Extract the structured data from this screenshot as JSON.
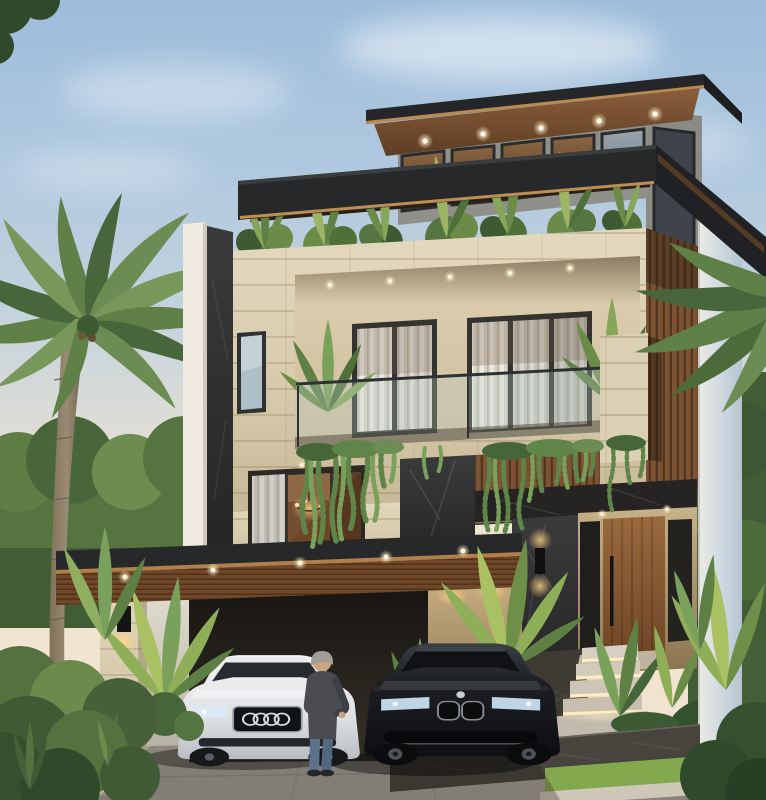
{
  "scene": {
    "kind": "architectural-exterior-3d-render",
    "subject": "modern three-storey tropical villa",
    "time_of_day": "dusk, warm interior and soffit lights on",
    "building": {
      "storeys": 3,
      "features": [
        "flat cantilevered dark roofs with wood soffits and recessed downlights",
        "clerestory window band on top floor",
        "roof-garden planter with tropical shrubs",
        "beige travertine facade with recessed balcony",
        "glass balustrade balcony with curtained windows",
        "hanging vine cascades over balcony fascia",
        "dark marble accent walls and entry header",
        "vertical wood slat cladding",
        "wood pivot front door with sidelights and black handle",
        "carport canopy with slatted wood underside and downlights",
        "lit entry steps with strip lighting",
        "tall rounded white pillar on right"
      ]
    },
    "vehicles": [
      {
        "type": "sedan",
        "color": "white",
        "grille_badge": "four overlapping rings"
      },
      {
        "type": "sedan",
        "color": "black",
        "grille_badge": "twin kidney grille"
      }
    ],
    "people": [
      {
        "description": "grey-haired man standing between the two cars",
        "clothing": "dark jacket and blue jeans"
      }
    ],
    "vegetation": [
      "coconut palm left",
      "palm fronds right edge",
      "background trees",
      "roof-garden shrubs",
      "hanging vines",
      "tropical planters",
      "hedges and lawn strips"
    ],
    "lighting": [
      "soffit downlights",
      "clerestory interior lights",
      "chandelier in first-floor window",
      "wall sconces",
      "step strip lights"
    ]
  },
  "palette": {
    "sky-top": "#9DBCDA",
    "sky-horizon": "#F2E6D2",
    "roof-dark": "#26282A",
    "gold-trim": "#BE8E55",
    "soffit-wood": "#7E5536",
    "slat-wood": "#7D5433",
    "stone-beige": "#DCD0B4",
    "marble-dark": "#312F2D",
    "white-wall": "#EFEBE1",
    "pillar-blue": "#C3D0DA",
    "glass-cool": "#9FB0B8",
    "interior-warm": "#8A5E38",
    "light-warm": "#FFE9B8",
    "foliage-dark": "#3C5733",
    "foliage-mid": "#587B41",
    "foliage-light": "#7FA055",
    "foliage-bright": "#A9C163",
    "trunk": "#9A8B74",
    "car-white": "#E9E9EB",
    "car-black": "#1A1B1E",
    "driveway": "#ABA69C",
    "road": "#8A857C",
    "grass": "#7FA351"
  }
}
